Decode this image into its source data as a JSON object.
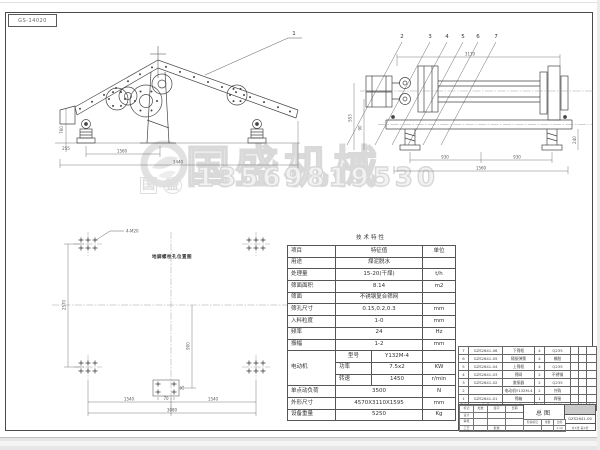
{
  "page": {
    "sheet_code": "GS-14020"
  },
  "watermark": {
    "brand": "国盛机械",
    "phone": "13569819530",
    "stamp_a": "国",
    "stamp_b": "盛"
  },
  "views": {
    "side": {
      "callout": "1",
      "dim_height": "760",
      "dim_foot": "255",
      "dim_mid": "1560",
      "dim_total": "3440"
    },
    "end": {
      "callouts": [
        "2",
        "3",
        "4",
        "5",
        "6",
        "7"
      ],
      "dim_top": "3110",
      "dim_left_a": "553",
      "dim_left_b": "90",
      "dim_bot_l": "930",
      "dim_bot_r": "930",
      "dim_bot_total": "1560",
      "dim_right": "240"
    },
    "plan": {
      "title": "地脚螺栓孔位置图",
      "bolt_label": "4-M20",
      "dim_left": "2570",
      "dim_center": "900",
      "dim_bot_l": "1540",
      "dim_bot_r": "1540",
      "dim_bot_total": "3080",
      "dim_sq_w": "70",
      "dim_sq_h": "75"
    }
  },
  "spec_table": {
    "title": "技术特性",
    "rows": [
      [
        {
          "t": "项目"
        },
        {
          "t": "特征值",
          "cs": 2
        },
        {
          "t": "单位"
        }
      ],
      [
        {
          "t": "用途"
        },
        {
          "t": "煤泥脱水",
          "cs": 2
        },
        {
          "t": ""
        }
      ],
      [
        {
          "t": "处理量"
        },
        {
          "t": "15-20(干煤)",
          "cs": 2
        },
        {
          "t": "t/h"
        }
      ],
      [
        {
          "t": "筛面面积"
        },
        {
          "t": "8.14",
          "cs": 2
        },
        {
          "t": "m2"
        }
      ],
      [
        {
          "t": "筛面"
        },
        {
          "t": "不锈钢复合筛网",
          "cs": 2
        },
        {
          "t": ""
        }
      ],
      [
        {
          "t": "筛孔尺寸"
        },
        {
          "t": "0.15,0.2,0.3",
          "cs": 2
        },
        {
          "t": "mm"
        }
      ],
      [
        {
          "t": "入料粒度"
        },
        {
          "t": "1-0",
          "cs": 2
        },
        {
          "t": "mm"
        }
      ],
      [
        {
          "t": "频率"
        },
        {
          "t": "24",
          "cs": 2
        },
        {
          "t": "Hz"
        }
      ],
      [
        {
          "t": "振幅"
        },
        {
          "t": "1-2",
          "cs": 2
        },
        {
          "t": "mm"
        }
      ],
      [
        {
          "t": "电动机",
          "rs": 3
        },
        {
          "t": "型号"
        },
        {
          "t": "Y132M-4"
        },
        {
          "t": ""
        }
      ],
      [
        {
          "t": "功率"
        },
        {
          "t": "7.5x2"
        },
        {
          "t": "KW"
        }
      ],
      [
        {
          "t": "转速"
        },
        {
          "t": "1450"
        },
        {
          "t": "r/min"
        }
      ],
      [
        {
          "t": "单点动负荷"
        },
        {
          "t": "3500",
          "cs": 2
        },
        {
          "t": "N"
        }
      ],
      [
        {
          "t": "外形尺寸"
        },
        {
          "t": "4570X3110X1595",
          "cs": 2
        },
        {
          "t": "mm"
        }
      ],
      [
        {
          "t": "设备重量"
        },
        {
          "t": "5250",
          "cs": 2
        },
        {
          "t": "Kg"
        }
      ]
    ]
  },
  "bom": {
    "items": [
      [
        "7",
        "GZS2641-06",
        "下筛框",
        "4",
        "Q235",
        "",
        "",
        ""
      ],
      [
        "6",
        "GZS2641-05",
        "隔振弹簧",
        "4",
        "橡胶",
        "",
        "",
        ""
      ],
      [
        "5",
        "GZS2641-04",
        "上筛框",
        "4",
        "Q235",
        "",
        "",
        ""
      ],
      [
        "4",
        "GZS2641-03",
        "筛网",
        "2",
        "不锈钢",
        "",
        "",
        ""
      ],
      [
        "3",
        "GZS2641-02",
        "激振器",
        "2",
        "Q235",
        "",
        "",
        ""
      ],
      [
        "2",
        "",
        "电动机Y132M-4",
        "2",
        "外购",
        "",
        "",
        ""
      ],
      [
        "1",
        "GZS2641-01",
        "筛箱",
        "1",
        "焊接",
        "",
        "",
        ""
      ]
    ],
    "header_rows": [
      [
        "序号",
        "代 号",
        "名 称",
        "数量",
        "材 料",
        "单件",
        "总计",
        "备注"
      ]
    ]
  },
  "title_block": {
    "name": "总图",
    "number": "GZS2641-00",
    "sheet_note": "共1张 第1张",
    "left_rows": [
      [
        "标记",
        "处数",
        "签字",
        "日期"
      ],
      [
        "设计",
        "",
        "",
        ""
      ],
      [
        "审核",
        "",
        "",
        ""
      ],
      [
        "工艺",
        "",
        "批准",
        ""
      ]
    ],
    "center_rows": [
      [
        "阶段标记",
        "重量",
        "比例"
      ],
      [
        "",
        "",
        "1:10"
      ]
    ]
  }
}
